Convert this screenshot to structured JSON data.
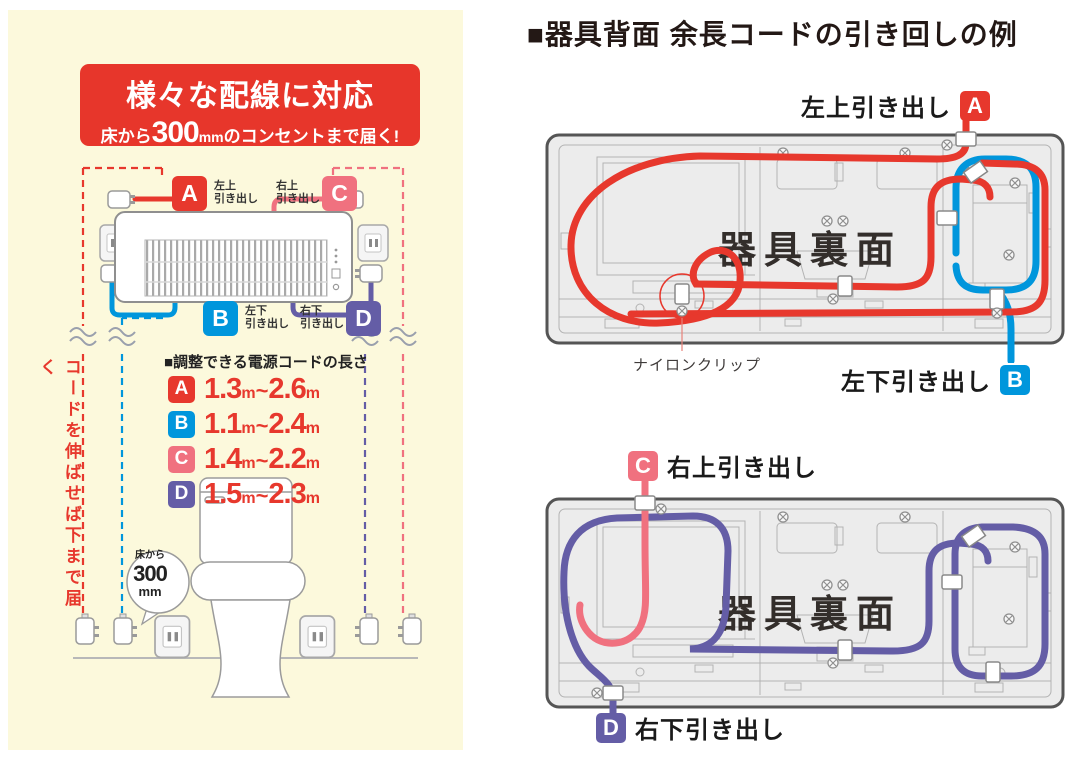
{
  "colors": {
    "red": "#e7382d",
    "blue": "#0096dc",
    "pink": "#f0717f",
    "purple": "#645da6",
    "banner_red": "#e7362b",
    "cream_bg": "#fcf9dc",
    "panel_gray": "#ececec",
    "panel_border": "#555555",
    "detail_line_gray": "#b3b3b3",
    "text_dark": "#231815"
  },
  "left_panel": {
    "banner": {
      "title": "様々な配線に対応",
      "sub_prefix": "床から",
      "sub_value": "300",
      "sub_unit": "mm",
      "sub_suffix": "のコンセントまで届く!"
    },
    "pullouts": {
      "a": {
        "letter": "A",
        "line1": "左上",
        "line2": "引き出し"
      },
      "b": {
        "letter": "B",
        "line1": "左下",
        "line2": "引き出し"
      },
      "c": {
        "letter": "C",
        "line1": "右上",
        "line2": "引き出し"
      },
      "d": {
        "letter": "D",
        "line1": "右下",
        "line2": "引き出し"
      }
    },
    "cord_lengths": {
      "heading": "■調整できる電源コードの長さ",
      "rows": [
        {
          "letter": "A",
          "min": "1.3",
          "tilde": "~",
          "max": "2.6",
          "unit": "m"
        },
        {
          "letter": "B",
          "min": "1.1",
          "tilde": "~",
          "max": "2.4",
          "unit": "m"
        },
        {
          "letter": "C",
          "min": "1.4",
          "tilde": "~",
          "max": "2.2",
          "unit": "m"
        },
        {
          "letter": "D",
          "min": "1.5",
          "tilde": "~",
          "max": "2.3",
          "unit": "m"
        }
      ]
    },
    "vertical_note": "コードを伸ばせば下まで届く",
    "bubble": {
      "line1": "床から",
      "value": "300",
      "unit": "mm"
    }
  },
  "right_panel": {
    "title": "■器具背面 余長コードの引き回しの例",
    "top_diagram": {
      "back_label": "器具裏面",
      "pullout_top": {
        "text": "左上引き出し",
        "letter": "A"
      },
      "pullout_bottom": {
        "text": "左下引き出し",
        "letter": "B"
      },
      "clip_note": "ナイロンクリップ"
    },
    "bottom_diagram": {
      "back_label": "器具裏面",
      "pullout_top": {
        "letter": "C",
        "text": "右上引き出し"
      },
      "pullout_bottom": {
        "letter": "D",
        "text": "右下引き出し"
      }
    }
  }
}
